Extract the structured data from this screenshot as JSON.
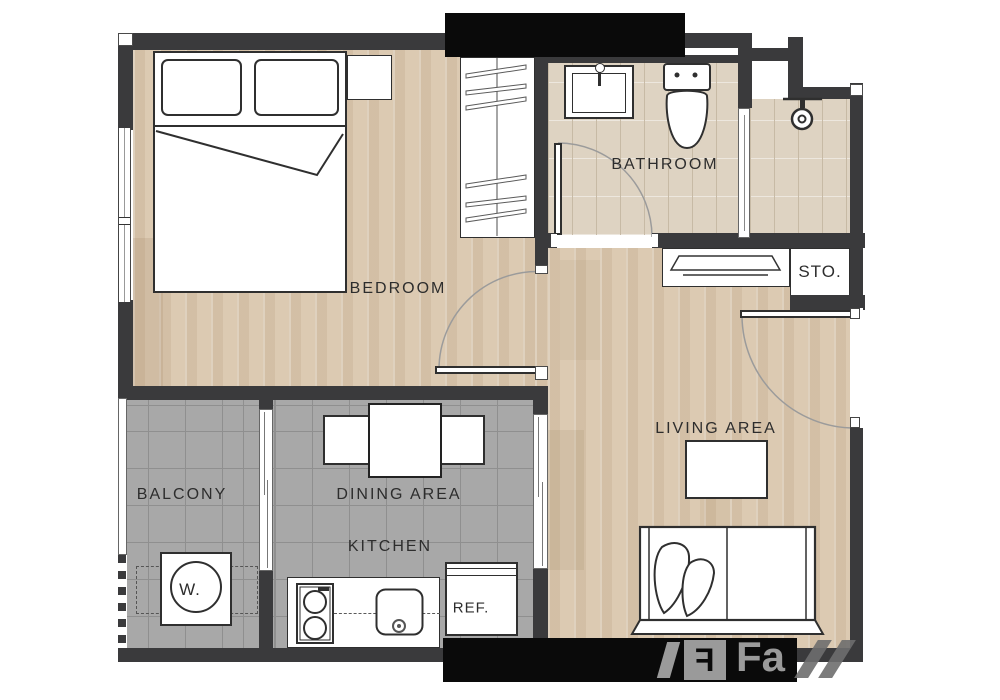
{
  "title": "1-bedroom apartment floor plan",
  "rooms": {
    "bedroom": {
      "label": "BEDROOM"
    },
    "bathroom": {
      "label": "BATHROOM"
    },
    "storage": {
      "label": "STO."
    },
    "living": {
      "label": "LIVING AREA"
    },
    "balcony": {
      "label": "BALCONY"
    },
    "dining": {
      "label": "DINING AREA"
    },
    "kitchen": {
      "label": "KITCHEN"
    },
    "refrigerator": {
      "label": "REF."
    },
    "washer": {
      "label": "W."
    }
  },
  "watermark": {
    "text": "Fa",
    "logo_letter": "F"
  },
  "palette": {
    "wall": "#3a3a3c",
    "wood": "#dccab2",
    "tile": "#a8a8a8",
    "tileline": "#8f8f8f",
    "bath": "#ded3c2",
    "bathline": "#c7baa5",
    "line": "#2f2f2f",
    "ink": "#2d2d2d",
    "black": "#0a0a0a",
    "wm": "#9a9a9a"
  }
}
